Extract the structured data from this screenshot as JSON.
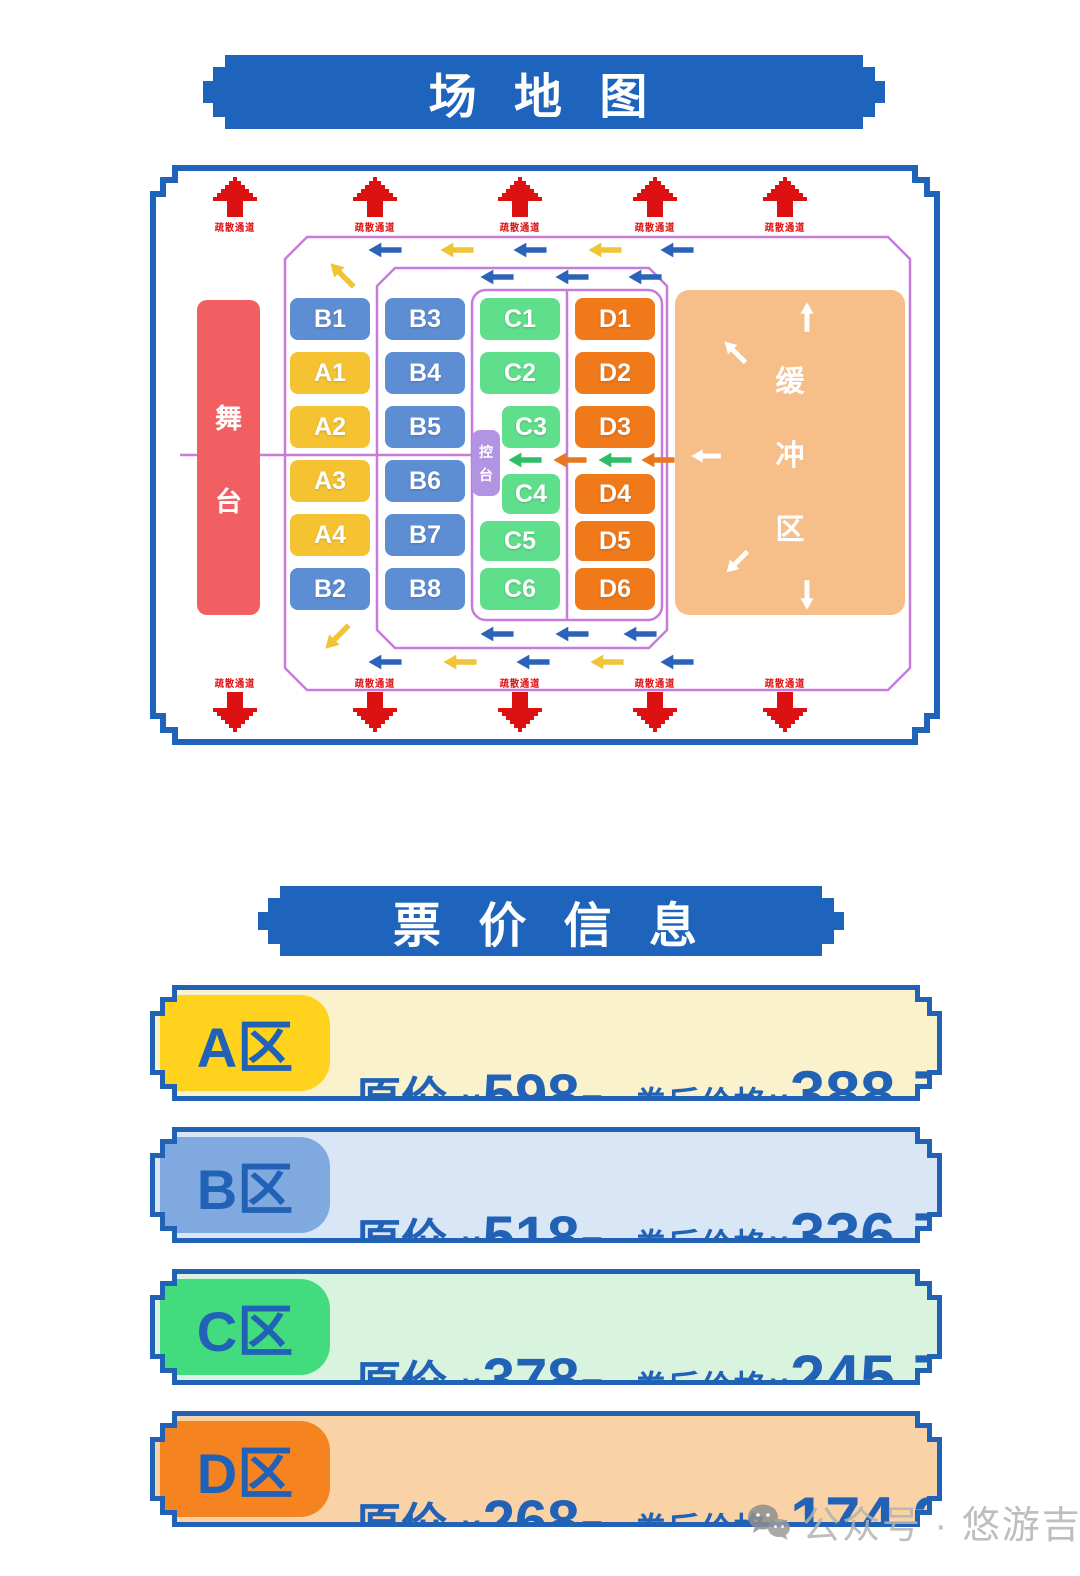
{
  "venue_map": {
    "title": "场 地 图",
    "exit_label": "疏散通道",
    "stage_label": "舞台",
    "control_desk_label": "控台",
    "buffer_label": "缓冲区",
    "columns": [
      [
        "B1",
        "A1",
        "A2",
        "A3",
        "A4",
        "B2"
      ],
      [
        "B3",
        "B4",
        "B5",
        "B6",
        "B7",
        "B8"
      ],
      [
        "C1",
        "C2",
        "C3",
        "C4",
        "C5",
        "C6"
      ],
      [
        "D1",
        "D2",
        "D3",
        "D4",
        "D5",
        "D6"
      ]
    ]
  },
  "pricing": {
    "title": "票 价 信 息",
    "original_label": "原价",
    "discount_label": "券后价格",
    "currency": "¥",
    "unit": "元",
    "rows": [
      {
        "zone": "A区",
        "original": "598",
        "discounted": "388.7"
      },
      {
        "zone": "B区",
        "original": "518",
        "discounted": "336.7"
      },
      {
        "zone": "C区",
        "original": "378",
        "discounted": "245.7"
      },
      {
        "zone": "D区",
        "original": "268",
        "discounted": "174.2"
      }
    ]
  },
  "watermark": {
    "icon": "wechat-icon",
    "text": "公众号 · 悠游吉林"
  },
  "colors": {
    "banner_blue": "#1E64BC",
    "price_text_blue": "#2262B6",
    "zone_A": "#F5C332",
    "zone_B": "#5D8DD3",
    "zone_C": "#5FDE8C",
    "zone_D": "#F0791A",
    "zone_A_bg": "#FAF2CC",
    "zone_B_bg": "#D8E6F6",
    "zone_C_bg": "#D8F4DE",
    "zone_D_bg": "#F9D2A6",
    "zone_A_chip": "#FFD21E",
    "zone_B_chip": "#7FA9DF",
    "zone_C_chip": "#42DB7E",
    "zone_D_chip": "#F5831F",
    "stage_red": "#F25F63",
    "buffer_orange": "#F6BE88",
    "control_purple": "#B394E4",
    "path_purple": "#C77BDB",
    "exit_red": "#DD1111",
    "arrow_blue": "#2B63B8",
    "arrow_yellow": "#EFC437",
    "arrow_green": "#2FBE66",
    "arrow_orange": "#E8761B",
    "arrow_white": "#FFFFFF"
  }
}
